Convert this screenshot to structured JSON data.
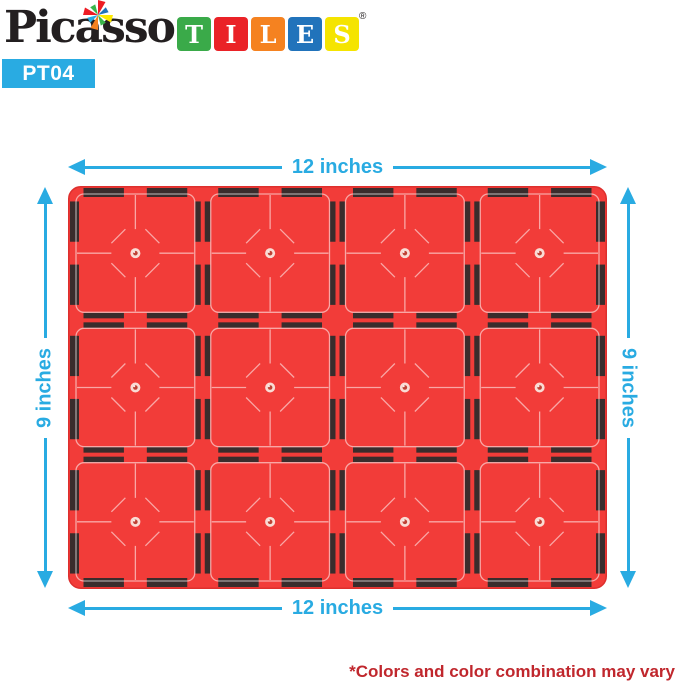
{
  "logo": {
    "brand": "Picasso",
    "brand_color": "#231f20",
    "registered_mark": "®",
    "tiles_blocks": [
      {
        "letter": "T",
        "color": "#3aaa49"
      },
      {
        "letter": "I",
        "color": "#ea2227"
      },
      {
        "letter": "L",
        "color": "#f58220"
      },
      {
        "letter": "E",
        "color": "#2173bb"
      },
      {
        "letter": "S",
        "color": "#f5e400"
      }
    ],
    "star_colors": [
      "#ed1c24",
      "#2173bb",
      "#fde900",
      "#39b54a",
      "#f58220",
      "#29abe2",
      "#ed1c24",
      "#39b54a"
    ],
    "product_code": "PT04",
    "product_code_bg": "#29abe2",
    "product_code_color": "#ffffff"
  },
  "dimensions": {
    "top_label": "12 inches",
    "bottom_label": "12 inches",
    "left_label": "9 inches",
    "right_label": "9 inches",
    "accent_color": "#29abe2"
  },
  "plate": {
    "grid_cols": 4,
    "grid_rows": 3,
    "tile_color": "#f23c39",
    "edge_color": "#de2f2d",
    "magnet_color": "#3a2c2c",
    "line_color": "#ffffff",
    "rivet_outer": "#f9dcd4",
    "rivet_inner": "#bf4134"
  },
  "disclaimer": {
    "text": "*Colors and color combination may vary",
    "color": "#c0272d"
  }
}
